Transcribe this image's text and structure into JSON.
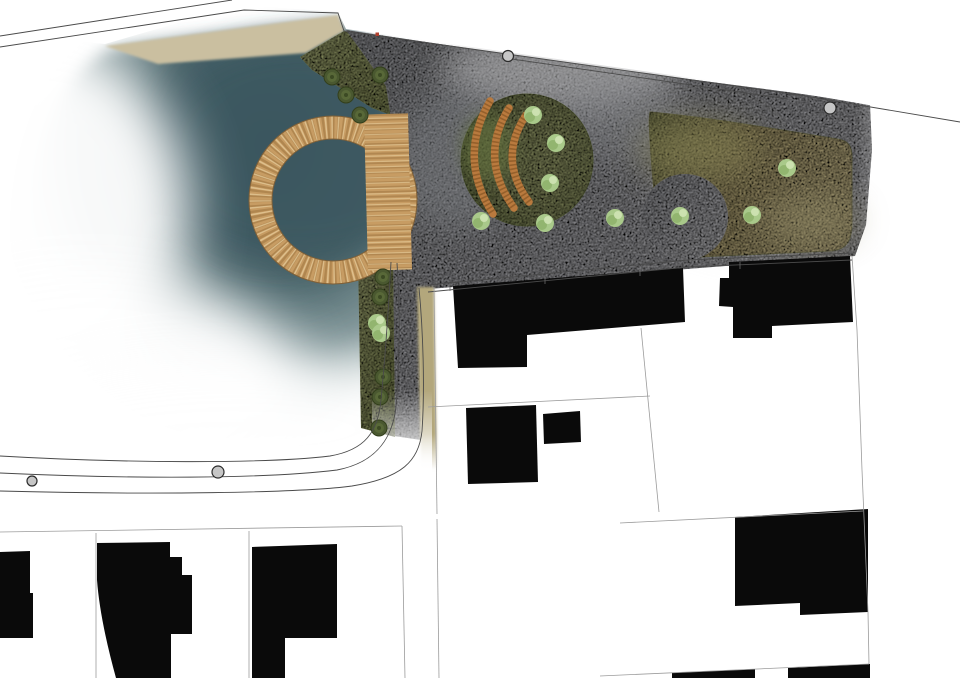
{
  "canvas": {
    "w": 960,
    "h": 678,
    "bg": "#ffffff"
  },
  "palette": {
    "water_deep": "#3c5860",
    "water_mid": "#486369",
    "plaza_grey": "#a9a9ad",
    "lawn_tan": "#ac9f72",
    "grass_olive": "#8a9161",
    "wood_base": "#c79c63",
    "wood_dark": "#9c7440",
    "wood_light": "#e8cf9e",
    "bench_wood": "#b97a3e",
    "tree_dark": "#4a5830",
    "shrub_light": "#a9c98a",
    "building_black": "#0a0a0a",
    "line_dark": "#4a4a4a",
    "line_parcel": "#9b9b9b",
    "marker_red": "#b2402e"
  },
  "layers": [
    {
      "kind": "path",
      "name": "pond-water",
      "d": "M112,48 L338,22 L380,50 L392,70 L394,260 L390,420 C330,442 180,430 92,386 C30,352 18,280 30,190 C40,120 70,70 112,48 Z",
      "fill": "def:pondGrad",
      "filter": "f8"
    },
    {
      "kind": "ellipse",
      "name": "pond-deep-core",
      "cx": 300,
      "cy": 150,
      "rx": 150,
      "ry": 110,
      "fill": "#3b565e",
      "opacity": 0.7,
      "filter": "f16"
    },
    {
      "kind": "ellipse",
      "name": "pond-fade-west",
      "cx": 40,
      "cy": 210,
      "rx": 150,
      "ry": 170,
      "fill": "#ffffff",
      "opacity": 0.95,
      "filter": "f28"
    },
    {
      "kind": "ellipse",
      "name": "pond-fade-southwest",
      "cx": 90,
      "cy": 390,
      "rx": 210,
      "ry": 120,
      "fill": "#ffffff",
      "opacity": 0.95,
      "filter": "f28"
    },
    {
      "kind": "ellipse",
      "name": "pond-fade-south",
      "cx": 230,
      "cy": 430,
      "rx": 230,
      "ry": 70,
      "fill": "#ffffff",
      "opacity": 0.85,
      "filter": "f28"
    },
    {
      "kind": "path",
      "name": "shore-sand-band",
      "d": "M105,46 L338,15 L344,31 L306,53 L158,64 Z",
      "fill": "#cabfa0",
      "filter": "f1"
    },
    {
      "kind": "path",
      "name": "grass-wedge-north",
      "d": "M300,57 L344,31 L360,36 L430,62 L444,96 L420,126 L372,108 L312,70 Z",
      "fill": "def:oliveGrad",
      "filter": "speckle"
    },
    {
      "kind": "path",
      "name": "plaza-concrete",
      "d": "M346,30 L500,53 L650,74 L795,93 L870,104 L872,150 L866,225 L855,256 L428,289 L419,292 L421,440 L394,436 L392,262 L396,150 L386,86 L362,52 Z",
      "fill": "def:plazaGrad",
      "filter": "speckle"
    },
    {
      "kind": "ellipse",
      "name": "plaza-light-patch",
      "cx": 560,
      "cy": 70,
      "rx": 120,
      "ry": 40,
      "fill": "#c6c6c8",
      "opacity": 0.5,
      "filter": "f16"
    },
    {
      "kind": "ellipse",
      "name": "plaza-light-patch",
      "cx": 750,
      "cy": 200,
      "rx": 90,
      "ry": 50,
      "fill": "#c2c2c4",
      "opacity": 0.4,
      "filter": "f16"
    },
    {
      "kind": "ellipse",
      "name": "plaza-dark-patch",
      "cx": 455,
      "cy": 160,
      "rx": 60,
      "ry": 70,
      "fill": "#7e8185",
      "opacity": 0.45,
      "filter": "f16"
    },
    {
      "kind": "ellipse",
      "name": "plaza-dark-patch",
      "cx": 620,
      "cy": 120,
      "rx": 70,
      "ry": 40,
      "fill": "#898b8f",
      "opacity": 0.4,
      "filter": "f16"
    },
    {
      "kind": "path",
      "name": "grass-strip-east",
      "d": "M358,256 L393,262 L395,437 L361,428 Z",
      "fill": "def:oliveGrad",
      "filter": "speckle"
    },
    {
      "kind": "path",
      "name": "verge-strip-south",
      "d": "M417,287 L434,287 L437,470 L421,470 Z",
      "fill": "def:tanStripGrad",
      "filter": "f1"
    },
    {
      "kind": "path",
      "name": "lawn-east",
      "d": "M650,112 C700,116 770,128 838,139 C850,141 852,148 852,158 L852,222 C852,242 846,250 830,251 L700,257 C678,258 662,252 658,236 L652,170 C650,140 648,120 650,112 Z",
      "fill": "def:lawnGrad",
      "stroke": "#87875f",
      "sw": 0.8,
      "filter": "speckle"
    },
    {
      "kind": "ellipse",
      "name": "lawn-mottle",
      "cx": 700,
      "cy": 150,
      "rx": 60,
      "ry": 30,
      "fill": "#8f8a58",
      "opacity": 0.5,
      "filter": "f16"
    },
    {
      "kind": "ellipse",
      "name": "lawn-mottle",
      "cx": 810,
      "cy": 220,
      "rx": 50,
      "ry": 25,
      "fill": "#97906a",
      "opacity": 0.45,
      "filter": "f16"
    },
    {
      "kind": "circle",
      "name": "plaza-circle-pad",
      "cx": 685,
      "cy": 217,
      "r": 43,
      "fill": "def:plazaGrad",
      "filter": "speckle"
    },
    {
      "kind": "circle",
      "name": "amphitheater-lawn",
      "cx": 527,
      "cy": 160,
      "r": 66,
      "fill": "def:amphGrad",
      "stroke": "#76804f",
      "sw": 0.8,
      "filter": "speckle"
    },
    {
      "kind": "ellipse",
      "name": "amphitheater-moss",
      "cx": 488,
      "cy": 148,
      "rx": 26,
      "ry": 34,
      "fill": "#66743f",
      "opacity": 0.6,
      "filter": "f8"
    },
    {
      "kind": "path",
      "name": "road-white-cover-top",
      "d": "M0,0 L960,0 L960,121 L794,92 L650,72 L500,51 L346,29 L338,12 L240,5 L105,44 L0,34 Z",
      "fill": "#ffffff"
    },
    {
      "kind": "rect",
      "name": "fade-east",
      "x": 856,
      "y": 58,
      "w": 104,
      "h": 215,
      "fill": "def:fadeR"
    },
    {
      "kind": "rect",
      "name": "fade-strip-south",
      "x": 372,
      "y": 390,
      "w": 60,
      "h": 82,
      "fill": "def:fadeS"
    },
    {
      "kind": "ring",
      "name": "timber-ring-deck",
      "cx": 333,
      "cy": 200,
      "rMid": 72.5,
      "rOut": 84,
      "rIn": 61,
      "w": 23,
      "base": "#c79c63",
      "dark": "#9c7440",
      "light": "#e8cf9e",
      "edge": "#7f6038"
    },
    {
      "kind": "band",
      "name": "timber-deck-walkway",
      "x1": 386,
      "y1": 114,
      "x2": 390,
      "y2": 270,
      "w": 44,
      "base": "#c79c63",
      "dark": "#9c7440",
      "light": "#e8cf9e"
    },
    {
      "kind": "benches",
      "name": "amphitheater-bench",
      "w": 7.5,
      "base": "#b97a3e",
      "dark": "#7d4f1f",
      "items": [
        "M490,101 Q457,158 493,214",
        "M509,108 Q478,158 514,208",
        "M526,115 Q497,159 529,202"
      ]
    },
    {
      "kind": "trees",
      "name": "tree-dark",
      "r": 8,
      "fill": "#4a5830",
      "ring": "#333f1c",
      "mid": "#5a6a3a",
      "core": "#3c4a24",
      "items": [
        [
          332,
          77
        ],
        [
          380,
          75
        ],
        [
          346,
          95
        ],
        [
          360,
          115
        ],
        [
          383,
          277
        ],
        [
          380,
          297
        ],
        [
          383,
          377
        ],
        [
          380,
          397
        ],
        [
          379,
          428
        ]
      ]
    },
    {
      "kind": "shrubs",
      "name": "shrub-light",
      "r": 10,
      "base": "#a9c98a",
      "dark": "#8fb36c",
      "hi": "#cfe3b4",
      "items": [
        [
          533,
          115
        ],
        [
          556,
          143
        ],
        [
          550,
          183
        ],
        [
          481,
          221
        ],
        [
          545,
          223
        ],
        [
          615,
          218
        ],
        [
          680,
          216
        ],
        [
          752,
          215
        ],
        [
          787,
          168
        ],
        [
          377,
          323
        ],
        [
          381,
          333
        ]
      ]
    },
    {
      "kind": "paths",
      "name": "building-footprint",
      "fill": "#0a0a0a",
      "items": [
        "M453,286 L683,268 L685,322 L527,335 L527,367 L458,368 Z",
        "M466,408 L536,405 L538,482 L468,484 Z",
        "M543,414 L580,411 L581,442 L544,444 Z",
        "M729,262 L850,256 L853,322 L772,326 L772,338 L733,338 L733,307 L719,306 L720,278 L729,278 Z",
        "M735,517 L868,509 L868,612 L800,615 L800,603 L735,606 Z",
        "M0,552 L30,551 L30,593 L33,593 L33,638 L0,638 Z",
        "M97,543 L170,542 L170,557 L182,557 L182,575 L192,575 L192,634 L171,634 L171,678 L116,678 Q100,620 97,580 Z",
        "M252,547 L337,544 L337,638 L285,638 L285,678 L252,678 Z",
        "M672,673 L755,669 L755,678 L672,678 Z",
        "M788,668 L870,664 L870,678 L788,678 Z"
      ]
    },
    {
      "kind": "paths",
      "name": "road-edge-line",
      "stroke": "#4a4a4a",
      "sw": 0.9,
      "items": [
        "M0,36 L232,0",
        "M0,47 L244,10 L338,13 L344,31 L500,53 L650,74 L793,94 L960,122",
        "M505,58 L788,99",
        "M428,285 L688,260 L852,253",
        "M428,292 L688,267 L852,260",
        "M0,456 C120,463 265,464 330,456 C365,450 378,432 381,400 C386,348 389,300 391,262",
        "M0,473 C130,479 265,479 337,470 C374,463 392,441 396,407 C400,358 400,308 397,263",
        "M0,491 C150,495 300,493 352,486 C402,478 419,461 422,431 C425,388 423,330 419,288"
      ]
    },
    {
      "kind": "lines",
      "name": "road-tick",
      "stroke": "#6a6a6a",
      "sw": 0.8,
      "items": [
        [
          450,
          284,
          450,
          291
        ],
        [
          545,
          277,
          545,
          284
        ],
        [
          640,
          269,
          640,
          276
        ],
        [
          740,
          262,
          740,
          269
        ]
      ]
    },
    {
      "kind": "lines",
      "name": "parcel-line",
      "stroke": "#9b9b9b",
      "sw": 0.8,
      "items": [
        [
          0,
          532,
          402,
          526
        ],
        [
          96,
          533,
          96,
          678
        ],
        [
          249,
          531,
          249,
          678
        ],
        [
          402,
          526,
          405,
          678
        ],
        [
          437,
          519,
          439,
          678
        ],
        [
          434,
          287,
          437,
          514
        ],
        [
          620,
          523,
          863,
          511
        ],
        [
          641,
          328,
          659,
          512
        ],
        [
          428,
          407,
          650,
          396
        ],
        [
          600,
          676,
          869,
          664
        ]
      ]
    },
    {
      "kind": "paths",
      "name": "parcel-line-east",
      "stroke": "#9b9b9b",
      "sw": 0.8,
      "items": [
        "M852,256 L857,330 L862,470 L868,612 L869,664"
      ]
    },
    {
      "kind": "markers",
      "name": "street-tree-marker",
      "fill": "#c6c6c6",
      "stroke": "#2b2b2b",
      "items": [
        [
          508,
          56,
          5.5
        ],
        [
          830,
          108,
          6
        ],
        [
          218,
          472,
          6
        ],
        [
          32,
          481,
          5
        ]
      ]
    },
    {
      "kind": "rect",
      "name": "survey-red-dot",
      "x": 375.5,
      "y": 32.5,
      "w": 3.5,
      "h": 3.5,
      "fill": "#b2402e"
    }
  ]
}
